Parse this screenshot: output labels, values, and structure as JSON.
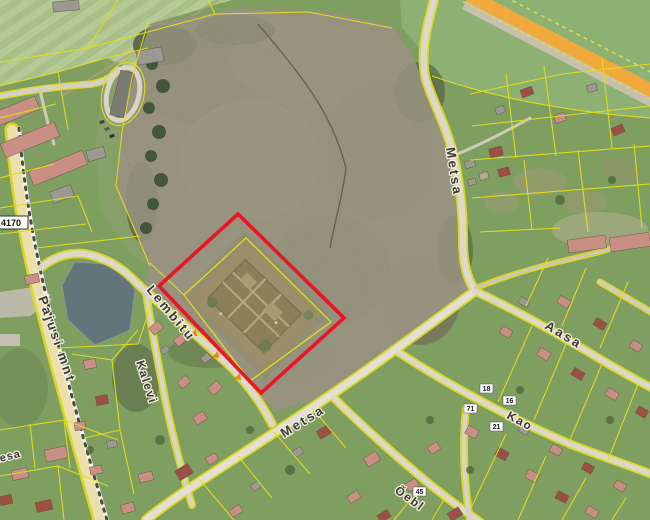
{
  "map": {
    "type": "aerial-cadastral-map",
    "labels": {
      "pajusi": "Pajusi mnt",
      "lembitu": "Lembitu",
      "kalevi": "Kalevi",
      "metsa_north": "Metsa",
      "metsa_south": "Metsa",
      "aasa": "Aasa",
      "kao": "Kao",
      "oebl": "Õebl",
      "kesa": "Kesa"
    },
    "road_number": "4170",
    "house_numbers": {
      "n18": "18",
      "n16": "16",
      "n71": "71",
      "n21": "21",
      "n45": "45"
    },
    "colors": {
      "cadastral_line": "#e4de17",
      "selected_parcel_outline": "#ea1626",
      "route_highlight": "#f1a93c",
      "pond": "#64737c"
    }
  }
}
